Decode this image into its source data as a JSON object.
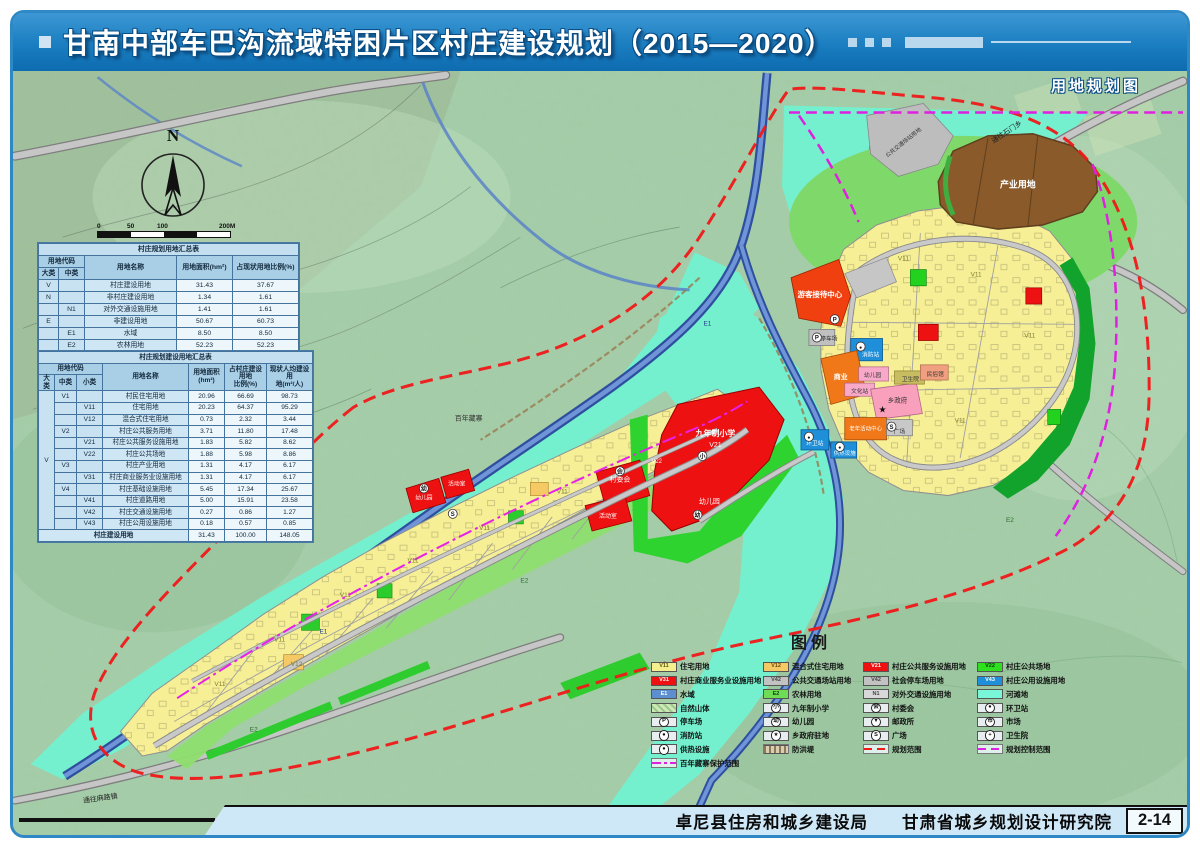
{
  "banner": {
    "title": "甘南中部车巴沟流域特困片区村庄建设规划（2015—2020）",
    "subtitle": "用地规划图"
  },
  "footer": {
    "agency1": "卓尼县住房和城乡建设局",
    "agency2": "甘肃省城乡规划设计研究院",
    "page_no": "2-14"
  },
  "compass": {
    "label": "N"
  },
  "scalebar": {
    "ticks": [
      "0",
      "50",
      "100",
      "200M"
    ]
  },
  "colors": {
    "banner_blue": "#1a7ec0",
    "residential": "#f6ef96",
    "commercial": "#ee1111",
    "public_green": "#22d21f",
    "utility_blue": "#1e8fd8",
    "water": "#4668b8",
    "floodplain": "#74f0cf",
    "industry_brown": "#8a5a2a",
    "boundary_red": "#f01818",
    "boundary_magenta": "#e020e0",
    "farm_green": "#8ede6e"
  },
  "table1": {
    "title": "村庄规划用地汇总表",
    "header": {
      "code": "用地代码",
      "big": "大类",
      "mid": "中类",
      "name": "用地名称",
      "area": "用地面积(hm²)",
      "pct": "占现状用地比例(%)"
    },
    "rows": [
      {
        "big": "V",
        "mid": "",
        "name": "村庄建设用地",
        "area": "31.43",
        "pct": "37.67"
      },
      {
        "big": "N",
        "mid": "",
        "name": "非村庄建设用地",
        "area": "1.34",
        "pct": "1.61"
      },
      {
        "big": "",
        "mid": "N1",
        "name": "对外交通设施用地",
        "area": "1.41",
        "pct": "1.61"
      },
      {
        "big": "E",
        "mid": "",
        "name": "非建设用地",
        "area": "50.67",
        "pct": "60.73"
      },
      {
        "big": "",
        "mid": "E1",
        "name": "水域",
        "area": "8.50",
        "pct": "8.50"
      },
      {
        "big": "",
        "mid": "E2",
        "name": "农林用地",
        "area": "52.23",
        "pct": "52.23"
      },
      {
        "total": true,
        "name": "村庄规划用地",
        "area": "83.44",
        "pct": "100.00"
      }
    ]
  },
  "table2": {
    "title": "村庄规划建设用地汇总表",
    "header": {
      "code": "用地代码",
      "c1": "大类",
      "c2": "中类",
      "c3": "小类",
      "name": "用地名称",
      "area": "用地面积\n(hm²)",
      "pct": "占村庄建设用地\n比例(%)",
      "cap": "现状人均建设用\n地(m²/人)"
    },
    "rows": [
      {
        "c": [
          "V",
          "V1",
          ""
        ],
        "name": "村民住宅用地",
        "area": "20.96",
        "pct": "66.69",
        "cap": "98.73"
      },
      {
        "c": [
          "",
          "",
          "V11"
        ],
        "name": "住宅用地",
        "area": "20.23",
        "pct": "64.37",
        "cap": "95.29"
      },
      {
        "c": [
          "",
          "",
          "V12"
        ],
        "name": "混合式住宅用地",
        "area": "0.73",
        "pct": "2.32",
        "cap": "3.44"
      },
      {
        "c": [
          "",
          "V2",
          ""
        ],
        "name": "村庄公共服务用地",
        "area": "3.71",
        "pct": "11.80",
        "cap": "17.48"
      },
      {
        "c": [
          "",
          "",
          "V21"
        ],
        "name": "村庄公共服务设施用地",
        "area": "1.83",
        "pct": "5.82",
        "cap": "8.62"
      },
      {
        "c": [
          "",
          "",
          "V22"
        ],
        "name": "村庄公共场地",
        "area": "1.88",
        "pct": "5.98",
        "cap": "8.86"
      },
      {
        "c": [
          "",
          "V3",
          ""
        ],
        "name": "村庄产业用地",
        "area": "1.31",
        "pct": "4.17",
        "cap": "6.17"
      },
      {
        "c": [
          "",
          "",
          "V31"
        ],
        "name": "村庄商业服务业设施用地",
        "area": "1.31",
        "pct": "4.17",
        "cap": "6.17"
      },
      {
        "c": [
          "",
          "V4",
          ""
        ],
        "name": "村庄基础设施用地",
        "area": "5.45",
        "pct": "17.34",
        "cap": "25.67"
      },
      {
        "c": [
          "",
          "",
          "V41"
        ],
        "name": "村庄道路用地",
        "area": "5.00",
        "pct": "15.91",
        "cap": "23.58"
      },
      {
        "c": [
          "",
          "",
          "V42"
        ],
        "name": "村庄交通设施用地",
        "area": "0.27",
        "pct": "0.86",
        "cap": "1.27"
      },
      {
        "c": [
          "",
          "",
          "V43"
        ],
        "name": "村庄公用设施用地",
        "area": "0.18",
        "pct": "0.57",
        "cap": "0.85"
      },
      {
        "total": true,
        "name": "村庄建设用地",
        "area": "31.43",
        "pct": "100.00",
        "cap": "148.05"
      }
    ]
  },
  "legend": {
    "title": "图例",
    "columns": [
      [
        {
          "kind": "swatch",
          "color": "#f6ef8e",
          "text_color": "#5a5a14",
          "code": "V11",
          "label": "住宅用地"
        },
        {
          "kind": "swatch",
          "color": "#ee1111",
          "text_color": "#ffffff",
          "code": "V31",
          "label": "村庄商业服务业设施用地"
        },
        {
          "kind": "swatch",
          "color": "#5b8fd0",
          "text_color": "#ffffff",
          "code": "E1",
          "label": "水域"
        },
        {
          "kind": "hatch",
          "label": "自然山体"
        },
        {
          "kind": "icon",
          "glyph": "P",
          "label": "停车场"
        },
        {
          "kind": "icon",
          "glyph": "●",
          "label": "消防站"
        },
        {
          "kind": "icon",
          "glyph": "●",
          "label": "供热设施"
        },
        {
          "kind": "line",
          "style": "dashdot",
          "color": "#e020e0",
          "label": "百年藏寨保护范围"
        }
      ],
      [
        {
          "kind": "swatch",
          "color": "#f5c963",
          "text_color": "#6a4a10",
          "code": "V12",
          "label": "混合式住宅用地"
        },
        {
          "kind": "swatch",
          "color": "#c2c2c2",
          "text_color": "#444444",
          "code": "V42",
          "label": "公共交通场站用地"
        },
        {
          "kind": "swatch",
          "color": "#6fdc55",
          "text_color": "#114411",
          "code": "E2",
          "label": "农林用地"
        },
        {
          "kind": "icon",
          "glyph": "小",
          "label": "九年制小学"
        },
        {
          "kind": "icon",
          "glyph": "幼",
          "label": "幼儿园"
        },
        {
          "kind": "icon",
          "glyph": "★",
          "label": "乡政府驻地"
        },
        {
          "kind": "line",
          "style": "dike",
          "label": "防洪堤"
        }
      ],
      [
        {
          "kind": "swatch",
          "color": "#ee1111",
          "text_color": "#ffffff",
          "code": "V21",
          "label": "村庄公共服务设施用地"
        },
        {
          "kind": "swatch",
          "color": "#c2c2c2",
          "text_color": "#444444",
          "code": "V42",
          "label": "社会停车场用地"
        },
        {
          "kind": "swatch",
          "color": "#d8d8d8",
          "text_color": "#444444",
          "code": "N1",
          "label": "对外交通设施用地"
        },
        {
          "kind": "icon",
          "glyph": "会",
          "label": "村委会"
        },
        {
          "kind": "icon",
          "glyph": "▼",
          "label": "邮政所"
        },
        {
          "kind": "icon",
          "glyph": "S",
          "label": "广场"
        },
        {
          "kind": "line",
          "style": "dashed",
          "color": "#f01818",
          "label": "规划范围"
        }
      ],
      [
        {
          "kind": "swatch",
          "color": "#2ee01e",
          "text_color": "#0a420a",
          "code": "V22",
          "label": "村庄公共场地"
        },
        {
          "kind": "swatch",
          "color": "#1e8fd8",
          "text_color": "#ffffff",
          "code": "V43",
          "label": "村庄公用设施用地"
        },
        {
          "kind": "swatch",
          "color": "#79f5d7",
          "text_color": "#0c5a4a",
          "code": "",
          "label": "河滩地"
        },
        {
          "kind": "icon",
          "glyph": "●",
          "label": "环卫站"
        },
        {
          "kind": "icon",
          "glyph": "市",
          "label": "市场"
        },
        {
          "kind": "icon",
          "glyph": "+",
          "label": "卫生院"
        },
        {
          "kind": "line",
          "style": "dashed",
          "color": "#e020e0",
          "label": "规划控制范围"
        }
      ]
    ]
  },
  "map": {
    "labels": [
      {
        "t": "产业用地",
        "x": 1020,
        "y": 201,
        "s": 9,
        "f": "#ffffff",
        "b": 1
      },
      {
        "t": "公共交通场站用地",
        "x": 906,
        "y": 158,
        "s": 5.5,
        "f": "#333333",
        "r": -38
      },
      {
        "t": "通往石门乡",
        "x": 1010,
        "y": 148,
        "s": 7,
        "f": "#222222",
        "r": -33
      },
      {
        "t": "游客接待中心",
        "x": 821,
        "y": 309,
        "s": 7.5,
        "f": "#ffffff",
        "b": 1
      },
      {
        "t": "停车场",
        "x": 830,
        "y": 352,
        "s": 5.8,
        "f": "#222222"
      },
      {
        "t": "消防站",
        "x": 872,
        "y": 368,
        "s": 5.8,
        "f": "#ffffff"
      },
      {
        "t": "商业",
        "x": 842,
        "y": 390,
        "s": 7,
        "f": "#ffffff",
        "b": 1
      },
      {
        "t": "幼儿园",
        "x": 874,
        "y": 388,
        "s": 5.8,
        "f": "#333333"
      },
      {
        "t": "文化站",
        "x": 861,
        "y": 404,
        "s": 5.8,
        "f": "#333333"
      },
      {
        "t": "卫生院",
        "x": 912,
        "y": 392,
        "s": 5.8,
        "f": "#333333"
      },
      {
        "t": "民俗馆",
        "x": 937,
        "y": 387,
        "s": 5.8,
        "f": "#333333"
      },
      {
        "t": "乡政府",
        "x": 899,
        "y": 413,
        "s": 6.5,
        "f": "#333333"
      },
      {
        "t": "老年活动中心",
        "x": 867,
        "y": 441,
        "s": 5.5,
        "f": "#ffffff"
      },
      {
        "t": "广场",
        "x": 901,
        "y": 444,
        "s": 5.8,
        "f": "#333333"
      },
      {
        "t": "环卫站",
        "x": 816,
        "y": 455,
        "s": 5.8,
        "f": "#ffffff"
      },
      {
        "t": "供热设施",
        "x": 846,
        "y": 465,
        "s": 5.5,
        "f": "#ffffff"
      },
      {
        "t": "九年制小学",
        "x": 716,
        "y": 446,
        "s": 8,
        "f": "#ffffff",
        "b": 1
      },
      {
        "t": "V21",
        "x": 716,
        "y": 457,
        "s": 7,
        "f": "#ffffff"
      },
      {
        "t": "幼儿园",
        "x": 710,
        "y": 513,
        "s": 7,
        "f": "#ffffff"
      },
      {
        "t": "村委会",
        "x": 620,
        "y": 491,
        "s": 7,
        "f": "#ffffff"
      },
      {
        "t": "活动室",
        "x": 608,
        "y": 527,
        "s": 6,
        "f": "#ffffff"
      },
      {
        "t": "百年藏寨",
        "x": 468,
        "y": 431,
        "s": 7,
        "f": "#333333"
      },
      {
        "t": "幼儿园",
        "x": 423,
        "y": 509,
        "s": 5.8,
        "f": "#ffffff"
      },
      {
        "t": "活动室",
        "x": 456,
        "y": 495,
        "s": 5.8,
        "f": "#ffffff"
      },
      {
        "t": "通往麻路镇",
        "x": 98,
        "y": 806,
        "s": 7,
        "f": "#222222",
        "r": -8
      },
      {
        "t": "V11",
        "x": 218,
        "y": 693,
        "s": 6.5,
        "f": "#7d7d2e"
      },
      {
        "t": "V11",
        "x": 278,
        "y": 649,
        "s": 6.5,
        "f": "#7d7d2e"
      },
      {
        "t": "V11",
        "x": 344,
        "y": 605,
        "s": 6.5,
        "f": "#7d7d2e"
      },
      {
        "t": "V11",
        "x": 412,
        "y": 571,
        "s": 6.5,
        "f": "#7d7d2e"
      },
      {
        "t": "V11",
        "x": 484,
        "y": 539,
        "s": 6.5,
        "f": "#7d7d2e"
      },
      {
        "t": "V11",
        "x": 562,
        "y": 503,
        "s": 6.5,
        "f": "#7d7d2e"
      },
      {
        "t": "V11",
        "x": 905,
        "y": 273,
        "s": 6.5,
        "f": "#7d7d2e"
      },
      {
        "t": "V11",
        "x": 978,
        "y": 289,
        "s": 6.5,
        "f": "#7d7d2e"
      },
      {
        "t": "V11",
        "x": 1032,
        "y": 349,
        "s": 6.5,
        "f": "#7d7d2e"
      },
      {
        "t": "V11",
        "x": 962,
        "y": 433,
        "s": 6.5,
        "f": "#7d7d2e"
      },
      {
        "t": "V12",
        "x": 295,
        "y": 673,
        "s": 6.5,
        "f": "#7d7d2e"
      },
      {
        "t": "E2",
        "x": 524,
        "y": 591,
        "s": 6.5,
        "f": "#2d6e2d"
      },
      {
        "t": "E2",
        "x": 252,
        "y": 738,
        "s": 6.5,
        "f": "#2d6e2d"
      },
      {
        "t": "E2",
        "x": 1012,
        "y": 531,
        "s": 6.5,
        "f": "#2d6e2d"
      },
      {
        "t": "E1",
        "x": 708,
        "y": 337,
        "s": 6.5,
        "f": "#223b8a"
      },
      {
        "t": "E1",
        "x": 322,
        "y": 641,
        "s": 6.5,
        "f": "#223b8a"
      },
      {
        "t": "V22",
        "x": 657,
        "y": 473,
        "s": 6,
        "f": "#ffffff"
      }
    ],
    "icons": [
      {
        "g": "P",
        "x": 818,
        "y": 349
      },
      {
        "g": "●",
        "x": 862,
        "y": 358
      },
      {
        "g": "★",
        "x": 884,
        "y": 420,
        "plain": true
      },
      {
        "g": "S",
        "x": 893,
        "y": 437
      },
      {
        "g": "●",
        "x": 810,
        "y": 447
      },
      {
        "g": "●",
        "x": 841,
        "y": 457
      },
      {
        "g": "小",
        "x": 703,
        "y": 466
      },
      {
        "g": "幼",
        "x": 698,
        "y": 524
      },
      {
        "g": "会",
        "x": 620,
        "y": 481
      },
      {
        "g": "S",
        "x": 452,
        "y": 523
      },
      {
        "g": "幼",
        "x": 423,
        "y": 498
      },
      {
        "g": "P",
        "x": 836,
        "y": 331
      }
    ]
  }
}
